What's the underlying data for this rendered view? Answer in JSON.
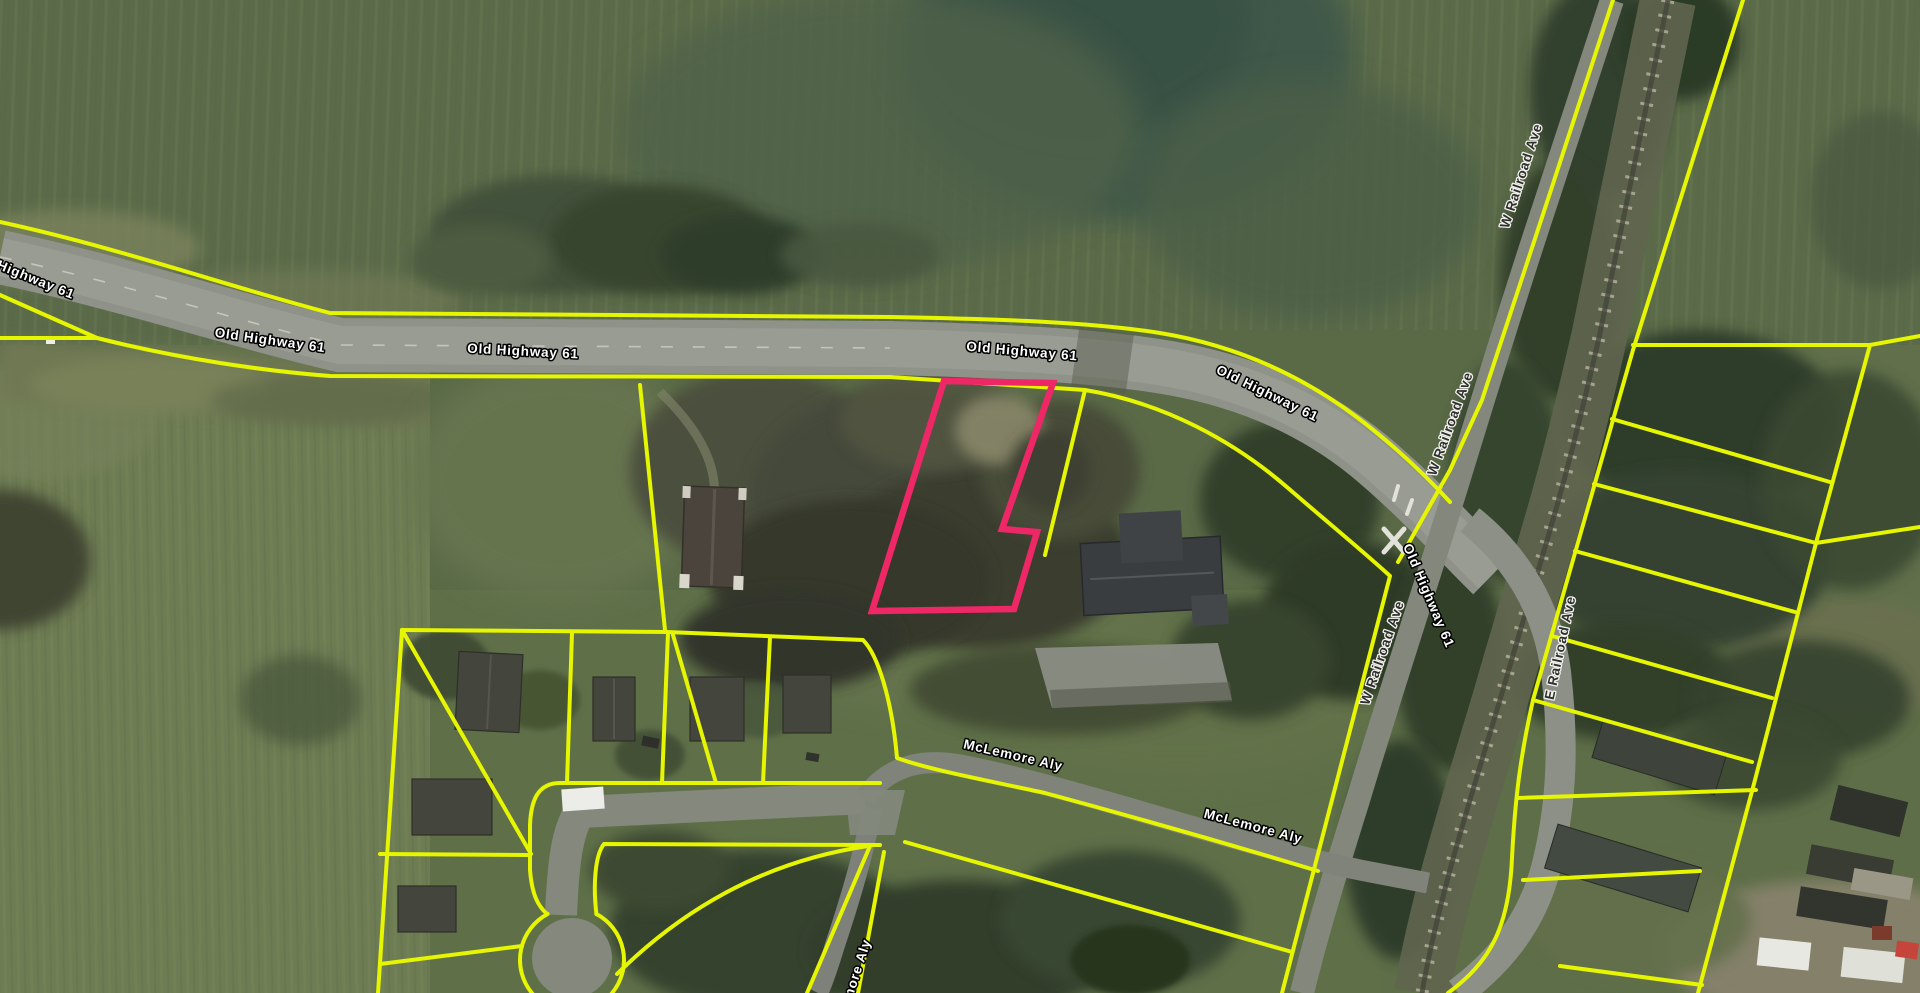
{
  "app": {
    "name": "parcel-map-satellite-view",
    "view": "aerial-imagery-with-parcel-overlay"
  },
  "map": {
    "colors": {
      "parcel_line": "#e6f500",
      "highlight_parcel": "#ee2767",
      "highway_label_fill": "#ffffff",
      "highway_label_halo": "#000000",
      "street_label_fill": "#2e2e2e",
      "street_label_halo": "#f2f2ec"
    },
    "labels": [
      {
        "text": "Old Highway 61",
        "style": "highway",
        "x": 22,
        "y": 275,
        "rot": 22
      },
      {
        "text": "Old Highway 61",
        "style": "highway",
        "x": 270,
        "y": 341,
        "rot": 8
      },
      {
        "text": "Old Highway 61",
        "style": "highway",
        "x": 523,
        "y": 352,
        "rot": 3
      },
      {
        "text": "Old Highway 61",
        "style": "highway",
        "x": 1022,
        "y": 352,
        "rot": 5
      },
      {
        "text": "Old Highway 61",
        "style": "highway",
        "x": 1267,
        "y": 394,
        "rot": 26
      },
      {
        "text": "Old Highway 61",
        "style": "highway",
        "x": 1428,
        "y": 596,
        "rot": 67
      },
      {
        "text": "W Railroad Ave",
        "style": "street",
        "x": 1522,
        "y": 176,
        "rot": -72
      },
      {
        "text": "W Railroad Ave",
        "style": "street",
        "x": 1451,
        "y": 424,
        "rot": -70
      },
      {
        "text": "W Railroad Ave",
        "style": "street",
        "x": 1383,
        "y": 653,
        "rot": -71
      },
      {
        "text": "E Railroad Ave",
        "style": "street",
        "x": 1561,
        "y": 648,
        "rot": -78
      },
      {
        "text": "McLemore Aly",
        "style": "highway",
        "x": 1013,
        "y": 756,
        "rot": 13
      },
      {
        "text": "McLemore Aly",
        "style": "highway",
        "x": 1253,
        "y": 827,
        "rot": 15
      },
      {
        "text": "McLemore Aly",
        "style": "highway",
        "x": 852,
        "y": 988,
        "rot": -72
      }
    ]
  }
}
